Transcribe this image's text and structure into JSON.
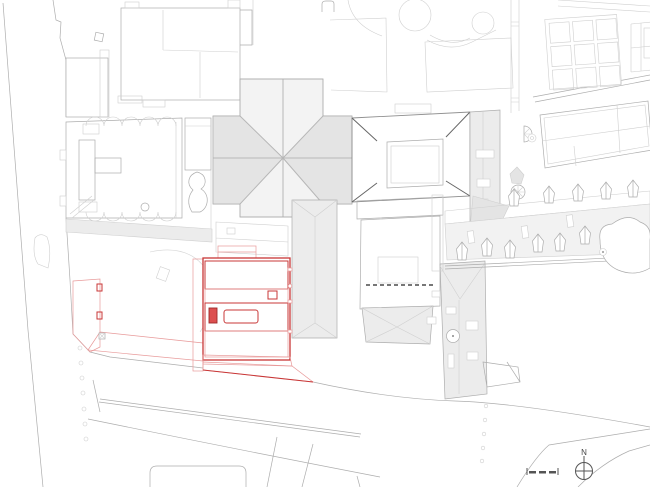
{
  "document": {
    "type": "architectural-site-plan",
    "description": "black-and-white site plan with red highlighted building and plaza",
    "visible_text": [
      "N"
    ]
  },
  "compass": {
    "label": "N",
    "icon": "north-arrow-icon"
  },
  "scale_bar": {
    "icon": "scale-bar",
    "segments": 3
  },
  "highlight": {
    "name": "highlighted-building",
    "outline": "#c83737",
    "band_fill": "#f2a6a6",
    "roof_object_fill": "#dc4f4f",
    "skylight_fill": "#f6b6b6",
    "plaza_hatch": "#f3baba"
  },
  "colors": {
    "bg": "#ffffff",
    "accent_red": "#c83737",
    "red_mid": "#dd7373",
    "red_hatch": "#f3baba",
    "red_light": "#e89a9a",
    "roof_gray": "#ececec",
    "roof_gray2": "#e4e4e4",
    "band_gray": "#f2f2f2",
    "line_xlight": "#cfcfcf",
    "line_light": "#adadad",
    "line_mid": "#8f8f8f",
    "line_dark": "#666666"
  }
}
